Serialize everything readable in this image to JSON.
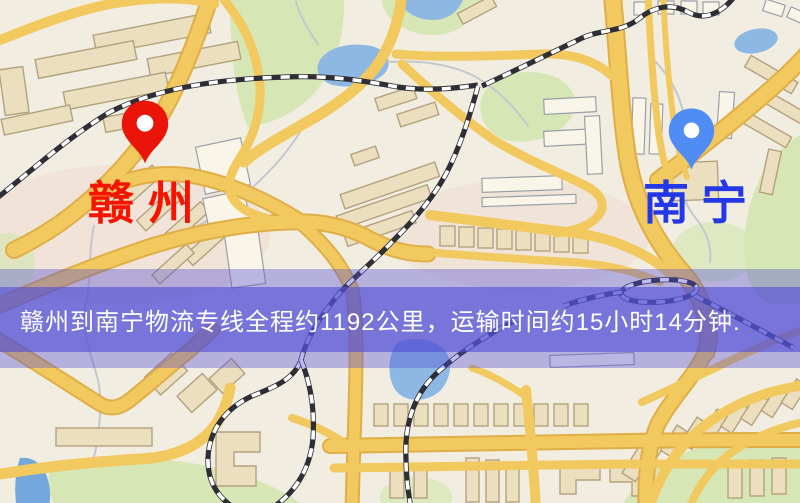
{
  "map": {
    "markers": [
      {
        "id": "origin",
        "city": "赣州",
        "pin_color": "#ea1508",
        "label_color": "#f51400"
      },
      {
        "id": "destination",
        "city": "南宁",
        "pin_color": "#4f8cf4",
        "label_color": "#2438e6"
      }
    ],
    "banner": {
      "text": "赣州到南宁物流专线全程约1192公里，运输时间约15小时14分钟.",
      "distance_text": "约1192公里",
      "duration_text": "约15小时14分钟"
    }
  },
  "theme": {
    "map_bg": "#f2ede1",
    "banner_bg": "#534fd6",
    "banner_fg": "#ffffff",
    "road": "#f2c95f",
    "road_edge": "#dfae47",
    "building": "#ebdfc0",
    "building_stroke": "#b3a27c",
    "building_light": "#faf5e9",
    "building_light_stroke": "#9aa0a8",
    "park": "#d6e6b4",
    "water": "#8db8e4",
    "stream": "#c2c8cc",
    "rail_dark": "#2e2e36",
    "rail_light": "#ffffff",
    "origin_pin": "#ea1508",
    "origin_label": "#f51400",
    "destination_pin": "#4f8cf4",
    "destination_label": "#2438e6"
  }
}
